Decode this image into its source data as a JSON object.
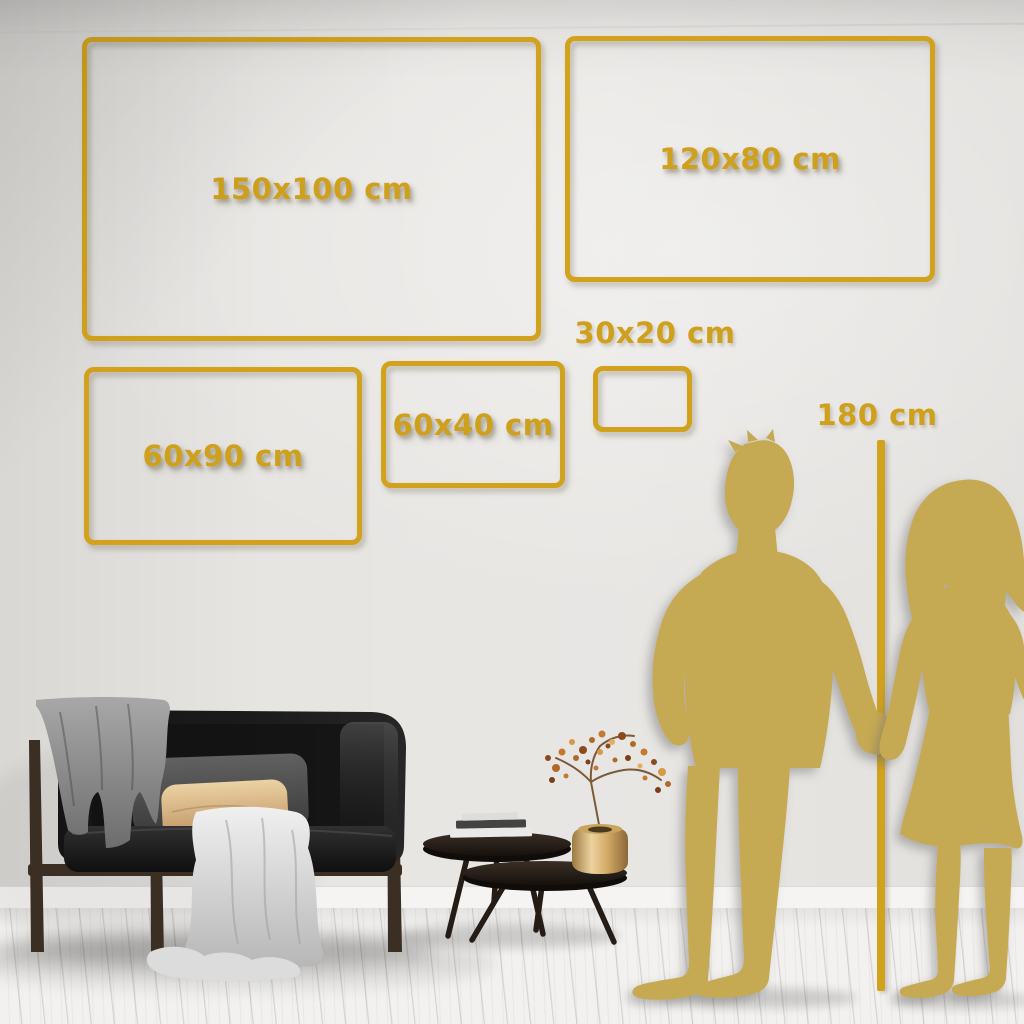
{
  "size_chart": {
    "frames": [
      {
        "label": "150x100 cm",
        "width_cm": 150,
        "height_cm": 100
      },
      {
        "label": "120x80 cm",
        "width_cm": 120,
        "height_cm": 80
      },
      {
        "label": "60x90 cm",
        "width_cm": 60,
        "height_cm": 90
      },
      {
        "label": "60x40 cm",
        "width_cm": 60,
        "height_cm": 40
      },
      {
        "label": "30x20 cm",
        "width_cm": 30,
        "height_cm": 20
      }
    ],
    "height_marker": {
      "label": "180 cm",
      "height_cm": 180
    }
  },
  "palette": {
    "frame_gold": "#D2A21D",
    "label_gold": "#CFA01B",
    "silhouette_gold": "#C6A953",
    "wall": "#E7E5E2",
    "floor": "#F2F1EF"
  },
  "scene": {
    "objects": [
      "sofa",
      "gray-blanket",
      "white-throw",
      "gray-pillow",
      "tan-pillow",
      "nesting-coffee-tables",
      "books",
      "brass-vase",
      "dried-branch",
      "man-silhouette",
      "woman-silhouette",
      "height-line"
    ]
  }
}
